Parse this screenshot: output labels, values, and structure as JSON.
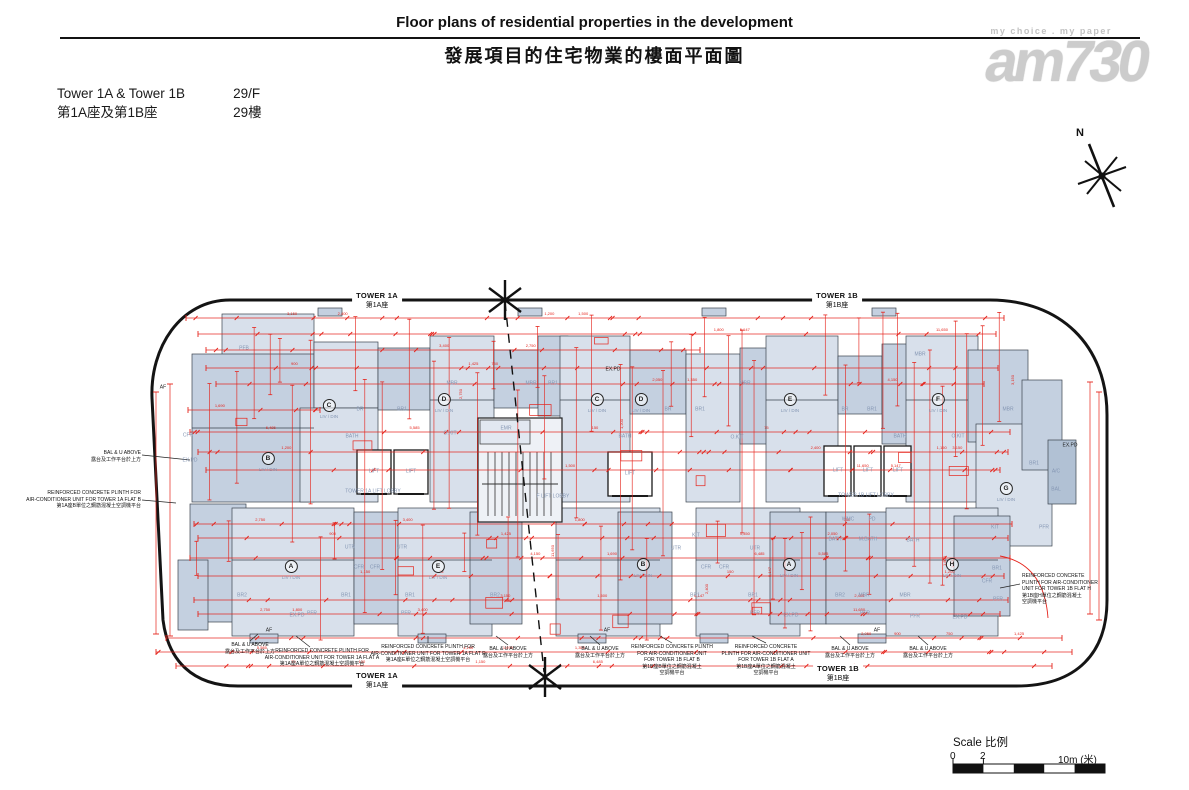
{
  "page": {
    "title_en": "Floor plans of residential properties in the development",
    "title_zh": "發展項目的住宅物業的樓面平面圖"
  },
  "info": {
    "towers_en": "Tower 1A & Tower 1B",
    "towers_zh": "第1A座及第1B座",
    "floor_en": "29/F",
    "floor_zh": "29樓"
  },
  "watermark": {
    "tagline": "my choice . my paper",
    "logo": "am730"
  },
  "compass": {
    "label": "N"
  },
  "plan": {
    "tower_markers": [
      {
        "x": 377,
        "y": 291,
        "en": "TOWER 1A",
        "zh": "第1A座"
      },
      {
        "x": 837,
        "y": 291,
        "en": "TOWER 1B",
        "zh": "第1B座"
      },
      {
        "x": 377,
        "y": 671,
        "en": "TOWER 1A",
        "zh": "第1A座"
      },
      {
        "x": 838,
        "y": 664,
        "en": "TOWER 1B",
        "zh": "第1B座"
      }
    ],
    "units": [
      {
        "letter": "B",
        "sub": "LIV / DIN",
        "x": 268,
        "y": 459
      },
      {
        "letter": "C",
        "sub": "LIV / DIN",
        "x": 329,
        "y": 406
      },
      {
        "letter": "D",
        "sub": "LIV / DIN",
        "x": 444,
        "y": 400
      },
      {
        "letter": "C",
        "sub": "LIV / DIN",
        "x": 597,
        "y": 400
      },
      {
        "letter": "D",
        "sub": "LIV / DIN",
        "x": 641,
        "y": 400
      },
      {
        "letter": "E",
        "sub": "LIV / DIN",
        "x": 790,
        "y": 400
      },
      {
        "letter": "F",
        "sub": "LIV / DIN",
        "x": 938,
        "y": 400
      },
      {
        "letter": "G",
        "sub": "LIV / DIN",
        "x": 1006,
        "y": 489
      },
      {
        "letter": "A",
        "sub": "LIV / DIN",
        "x": 291,
        "y": 567
      },
      {
        "letter": "E",
        "sub": "LIV / DIN",
        "x": 438,
        "y": 567
      },
      {
        "letter": "B",
        "sub": "LIV / DIN",
        "x": 643,
        "y": 565
      },
      {
        "letter": "A",
        "sub": "LIV / DIN",
        "x": 789,
        "y": 565
      },
      {
        "letter": "H",
        "sub": "LIV / DIN",
        "x": 952,
        "y": 565
      }
    ],
    "lobbies": [
      {
        "label": "TOWER 1A LIFT LOBBY",
        "x": 373,
        "y": 492
      },
      {
        "label": "F LIFT LOBBY",
        "x": 553,
        "y": 497
      },
      {
        "label": "TOWER 1B LIFT LOBBY",
        "x": 866,
        "y": 496
      }
    ],
    "lifts": [
      {
        "t": "LIFT",
        "x": 374,
        "y": 472
      },
      {
        "t": "LIFT",
        "x": 411,
        "y": 472
      },
      {
        "t": "LIFT",
        "x": 630,
        "y": 474
      },
      {
        "t": "LIFT",
        "x": 838,
        "y": 471
      },
      {
        "t": "LIFT",
        "x": 868,
        "y": 471
      },
      {
        "t": "LIFT",
        "x": 898,
        "y": 471
      }
    ],
    "rooms": [
      {
        "t": "PFB",
        "x": 244,
        "y": 349
      },
      {
        "t": "MBR",
        "x": 452,
        "y": 384
      },
      {
        "t": "MBR",
        "x": 531,
        "y": 384
      },
      {
        "t": "BR1",
        "x": 553,
        "y": 384
      },
      {
        "t": "BR",
        "x": 360,
        "y": 410
      },
      {
        "t": "BR1",
        "x": 402,
        "y": 410
      },
      {
        "t": "BATH",
        "x": 352,
        "y": 437
      },
      {
        "t": "O.KIT",
        "x": 450,
        "y": 434
      },
      {
        "t": "EMR",
        "x": 506,
        "y": 429
      },
      {
        "t": "BATH",
        "x": 625,
        "y": 437
      },
      {
        "t": "BR",
        "x": 668,
        "y": 410
      },
      {
        "t": "BR1",
        "x": 700,
        "y": 410
      },
      {
        "t": "MBR",
        "x": 745,
        "y": 384
      },
      {
        "t": "O.KIT",
        "x": 737,
        "y": 438
      },
      {
        "t": "BR",
        "x": 845,
        "y": 410
      },
      {
        "t": "BR1",
        "x": 872,
        "y": 410
      },
      {
        "t": "MBR",
        "x": 920,
        "y": 355
      },
      {
        "t": "BATH",
        "x": 900,
        "y": 437
      },
      {
        "t": "O.KIT",
        "x": 958,
        "y": 437
      },
      {
        "t": "MBR",
        "x": 1008,
        "y": 410
      },
      {
        "t": "BR1",
        "x": 1034,
        "y": 464
      },
      {
        "t": "A/C",
        "x": 1056,
        "y": 472
      },
      {
        "t": "BAL",
        "x": 1056,
        "y": 490
      },
      {
        "t": "KIT",
        "x": 995,
        "y": 528
      },
      {
        "t": "PFR",
        "x": 1044,
        "y": 528
      },
      {
        "t": "CFR",
        "x": 188,
        "y": 436
      },
      {
        "t": "EX.PD",
        "x": 190,
        "y": 461
      },
      {
        "t": "BR2",
        "x": 242,
        "y": 596
      },
      {
        "t": "BR1",
        "x": 346,
        "y": 596
      },
      {
        "t": "UTR",
        "x": 350,
        "y": 548
      },
      {
        "t": "CFR",
        "x": 359,
        "y": 568
      },
      {
        "t": "CFR",
        "x": 375,
        "y": 568
      },
      {
        "t": "UTR",
        "x": 402,
        "y": 548
      },
      {
        "t": "BR1",
        "x": 410,
        "y": 596
      },
      {
        "t": "BR2",
        "x": 495,
        "y": 596
      },
      {
        "t": "PFR",
        "x": 312,
        "y": 614
      },
      {
        "t": "EX.PD",
        "x": 297,
        "y": 616
      },
      {
        "t": "PFR",
        "x": 406,
        "y": 614
      },
      {
        "t": "UTR",
        "x": 676,
        "y": 549
      },
      {
        "t": "KIT",
        "x": 696,
        "y": 536
      },
      {
        "t": "CFR",
        "x": 706,
        "y": 568
      },
      {
        "t": "CFR",
        "x": 724,
        "y": 568
      },
      {
        "t": "UTR",
        "x": 755,
        "y": 549
      },
      {
        "t": "BR1",
        "x": 695,
        "y": 596
      },
      {
        "t": "BR1",
        "x": 753,
        "y": 596
      },
      {
        "t": "BR2",
        "x": 840,
        "y": 596
      },
      {
        "t": "MBR",
        "x": 864,
        "y": 596
      },
      {
        "t": "BATH",
        "x": 835,
        "y": 540
      },
      {
        "t": "M.BATH",
        "x": 868,
        "y": 540
      },
      {
        "t": "WMC",
        "x": 848,
        "y": 520
      },
      {
        "t": "PD",
        "x": 872,
        "y": 520
      },
      {
        "t": "PFR",
        "x": 755,
        "y": 614
      },
      {
        "t": "EX.PD",
        "x": 791,
        "y": 616
      },
      {
        "t": "PFR",
        "x": 865,
        "y": 614
      },
      {
        "t": "MBR",
        "x": 905,
        "y": 596
      },
      {
        "t": "PFR",
        "x": 915,
        "y": 617
      },
      {
        "t": "CFR",
        "x": 987,
        "y": 582
      },
      {
        "t": "BR1",
        "x": 997,
        "y": 569
      },
      {
        "t": "PFR",
        "x": 998,
        "y": 600
      },
      {
        "t": "EX.PD",
        "x": 960,
        "y": 618
      },
      {
        "t": "BATH",
        "x": 913,
        "y": 541
      }
    ],
    "black_labels": [
      {
        "t": "AF",
        "x": 163,
        "y": 388
      },
      {
        "t": "AF",
        "x": 269,
        "y": 631
      },
      {
        "t": "AF",
        "x": 607,
        "y": 631
      },
      {
        "t": "AF",
        "x": 877,
        "y": 631
      },
      {
        "t": "EX.PD",
        "x": 1070,
        "y": 446
      },
      {
        "t": "EX.PD",
        "x": 613,
        "y": 370
      }
    ],
    "dimension_values": [
      "1,200",
      "2,400",
      "3,150",
      "1,500",
      "5,147",
      "11,650",
      "1,800",
      "2,750",
      "3,400",
      "750",
      "900",
      "1,425",
      "2,050",
      "1,350",
      "4,150",
      "1,690",
      "5,585",
      "6,485",
      "150",
      "75",
      "1,150"
    ]
  },
  "annotations": {
    "callouts": [
      {
        "align": "r",
        "x": 141,
        "y": 450,
        "lines": [
          "BAL & U ABOVE",
          "露台及工作平台於上方"
        ]
      },
      {
        "align": "r",
        "x": 141,
        "y": 490,
        "lines": [
          "REINFORCED CONCRETE PLINTH FOR",
          "AIR-CONDITIONER UNIT FOR TOWER 1A FLAT B",
          "第1A座B單位之鋼筋混凝土空調機平台"
        ]
      },
      {
        "align": "c",
        "x": 250,
        "y": 642,
        "lines": [
          "BAL & U ABOVE",
          "露台及工作平台於上方"
        ]
      },
      {
        "align": "c",
        "x": 322,
        "y": 648,
        "lines": [
          "REINFORCED CONCRETE PLINTH FOR",
          "AIR-CONDITIONER UNIT FOR TOWER 1A FLAT A",
          "第1A座A單位之鋼筋混凝土空調機平台"
        ]
      },
      {
        "align": "c",
        "x": 428,
        "y": 644,
        "lines": [
          "REINFORCED CONCRETE PLINTH FOR",
          "AIR-CONDITIONER UNIT FOR TOWER 1A FLAT E",
          "第1A座E單位之鋼筋混凝土空調機平台"
        ]
      },
      {
        "align": "c",
        "x": 508,
        "y": 646,
        "lines": [
          "BAL & U ABOVE",
          "露台及工作平台於上方"
        ]
      },
      {
        "align": "c",
        "x": 600,
        "y": 646,
        "lines": [
          "BAL & U ABOVE",
          "露台及工作平台於上方"
        ]
      },
      {
        "align": "c",
        "x": 672,
        "y": 644,
        "lines": [
          "REINFORCED CONCRETE PLINTH",
          "FOR AIR-CONDITIONER UNIT",
          "FOR TOWER 1B FLAT B",
          "第1B座B單位之鋼筋混凝土",
          "空調機平台"
        ]
      },
      {
        "align": "c",
        "x": 766,
        "y": 644,
        "lines": [
          "REINFORCED CONCRETE",
          "PLINTH FOR AIR-CONDITIONER UNIT",
          "FOR TOWER 1B FLAT A",
          "第1B座A單位之鋼筋混凝土",
          "空調機平台"
        ]
      },
      {
        "align": "c",
        "x": 850,
        "y": 646,
        "lines": [
          "BAL & U ABOVE",
          "露台及工作平台於上方"
        ]
      },
      {
        "align": "c",
        "x": 928,
        "y": 646,
        "lines": [
          "BAL & U ABOVE",
          "露台及工作平台於上方"
        ]
      },
      {
        "align": "l",
        "x": 1022,
        "y": 573,
        "lines": [
          "REINFORCED CONCRETE",
          "PLINTH FOR AIR-CONDITIONER",
          "UNIT FOR TOWER 1B FLAT H",
          "第1B座H單位之鋼筋混凝土",
          "空調機平台"
        ]
      }
    ]
  },
  "scalebar": {
    "title": "Scale 比例",
    "t0": "0",
    "t1": "2",
    "t2": "10m (米)"
  },
  "colors": {
    "red": "#e5231b",
    "boundary": "#141414",
    "unit_light": "#d8e0eb",
    "unit_mid": "#c4d0e0",
    "unit_dark": "#b1c1d4",
    "wall": "#3a434e"
  }
}
